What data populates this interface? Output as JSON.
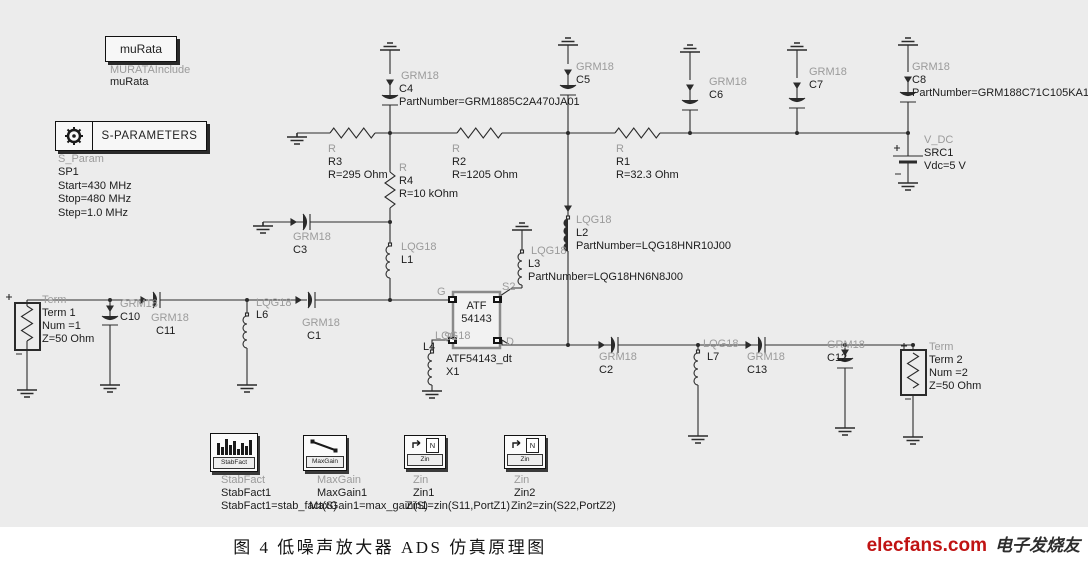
{
  "colors": {
    "bg": "#ececec",
    "wire": "#2b2b2b",
    "type_label": "#9b9b9b",
    "value_label": "#1c1c1c",
    "brand_red": "#c01313"
  },
  "murata": {
    "title": "muRata",
    "include_type": "MURATAInclude",
    "include_name": "muRata"
  },
  "sparams": {
    "title": "S-PARAMETERS",
    "type": "S_Param",
    "details": "SP1\nStart=430 MHz\nStop=480 MHz\nStep=1.0 MHz"
  },
  "components": {
    "term1": {
      "type": "Term",
      "text": "Term 1\nNum =1\nZ=50 Ohm"
    },
    "c10": {
      "type": "GRM18",
      "text": "C10"
    },
    "c11": {
      "type": "GRM18",
      "text": "C11"
    },
    "l6": {
      "type": "LQG18",
      "text": "L6"
    },
    "c1": {
      "type": "GRM18",
      "text": "C1"
    },
    "c3": {
      "type": "GRM18",
      "text": "C3"
    },
    "l1": {
      "type": "LQG18",
      "text": "L1"
    },
    "r3": {
      "type": "R",
      "text": "R3\nR=295 Ohm"
    },
    "r4": {
      "type": "R",
      "text": "R4\nR=10 kOhm"
    },
    "r2": {
      "type": "R",
      "text": "R2\nR=1205 Ohm"
    },
    "r1": {
      "type": "R",
      "text": "R1\nR=32.3 Ohm"
    },
    "c4": {
      "type": "GRM18",
      "text": "C4\nPartNumber=GRM1885C2A470JA01"
    },
    "c5": {
      "type": "GRM18",
      "text": "C5"
    },
    "c6": {
      "type": "GRM18",
      "text": "C6"
    },
    "c7": {
      "type": "GRM18",
      "text": "C7"
    },
    "c8": {
      "type": "GRM18",
      "text": "C8\nPartNumber=GRM188C71C105KA12"
    },
    "vdc": {
      "type": "V_DC",
      "text": "SRC1\nVdc=5 V"
    },
    "l2": {
      "type": "LQG18",
      "text": "L2\nPartNumber=LQG18HNR10J00"
    },
    "l3": {
      "type": "LQG18",
      "text": "L3\nPartNumber=LQG18HN6N8J00"
    },
    "l4": {
      "type": "LQG18",
      "text": "L4"
    },
    "c2": {
      "type": "GRM18",
      "text": "C2"
    },
    "l7": {
      "type": "LQG18",
      "text": "L7"
    },
    "c13": {
      "type": "GRM18",
      "text": "C13"
    },
    "c12": {
      "type": "GRM18",
      "text": "C12"
    },
    "term2": {
      "type": "Term",
      "text": "Term 2\nNum =2\nZ=50 Ohm"
    }
  },
  "transistor": {
    "label": "ATF\n54143",
    "instance": "ATF54143_dt\nX1",
    "pins": {
      "g": "G",
      "s2": "S2",
      "s1": "S1",
      "d": "D"
    }
  },
  "measurements": [
    {
      "icon_label": "StabFact",
      "type": "StabFact",
      "name": "StabFact1",
      "eq": "StabFact1=stab_fact(S)"
    },
    {
      "icon_label": "MaxGain",
      "type": "MaxGain",
      "name": "MaxGain1",
      "eq": "MaxGain1=max_gain(S)"
    },
    {
      "icon_label": "Zin",
      "icon_letter": "N",
      "type": "Zin",
      "name": "Zin1",
      "eq": "Zin1=zin(S11,PortZ1)"
    },
    {
      "icon_label": "Zin",
      "icon_letter": "N",
      "type": "Zin",
      "name": "Zin2",
      "eq": "Zin2=zin(S22,PortZ2)"
    }
  ],
  "caption": "图 4  低噪声放大器 ADS 仿真原理图",
  "watermark": {
    "brand": "elecfans.com",
    "cn": "电子发烧友"
  }
}
